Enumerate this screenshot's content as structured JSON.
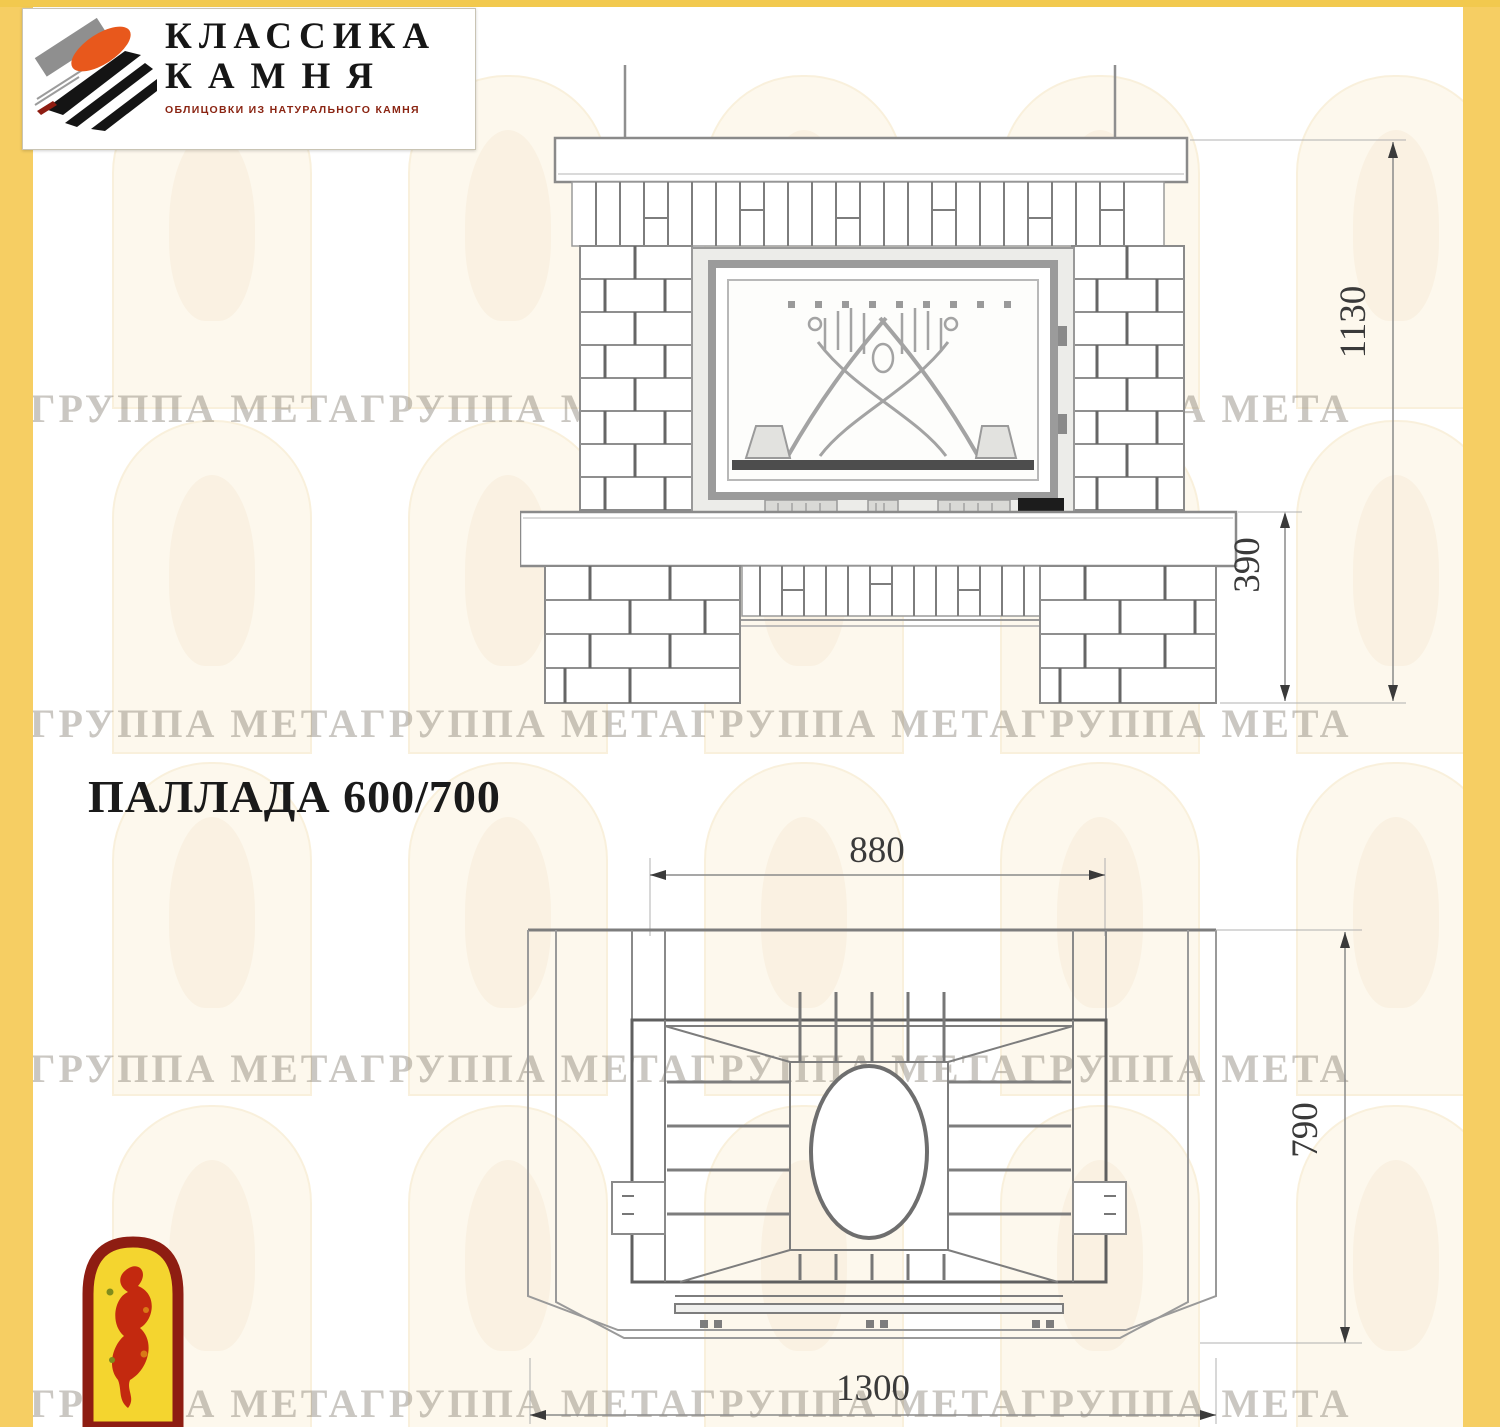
{
  "branding": {
    "logo_title_line1": "КЛАССИКА",
    "logo_title_line2": "КАМНЯ",
    "logo_tagline": "ОБЛИЦОВКИ ИЗ НАТУРАЛЬНОГО КАМНЯ"
  },
  "product": {
    "title": "ПАЛЛАДА 600/700"
  },
  "front_view": {
    "dim_total_height": "1130",
    "dim_plinth_height": "390"
  },
  "plan_view": {
    "dim_firebox_width": "880",
    "dim_depth": "790",
    "dim_total_width": "1300"
  },
  "watermark": {
    "text": "ГРУППА МЕТАГРУППА МЕТАГРУППА МЕТАГРУППА МЕТА"
  },
  "colors": {
    "edge_yellow": "#F6CE63",
    "edge_yellow_top": "#F2C94E",
    "logo_orange": "#E8581C",
    "logo_black": "#141414",
    "logo_gray": "#8F8F8F",
    "tagline_red": "#8A2412",
    "emblem_border_red": "#8E1D12",
    "emblem_fill_yellow": "#F4D52F",
    "emblem_figure_red": "#C3290F",
    "drawing_line_gray": "#8A8A8A",
    "dimension_text": "#3A3A3A",
    "watermark_arch": "#FCF4DF"
  }
}
